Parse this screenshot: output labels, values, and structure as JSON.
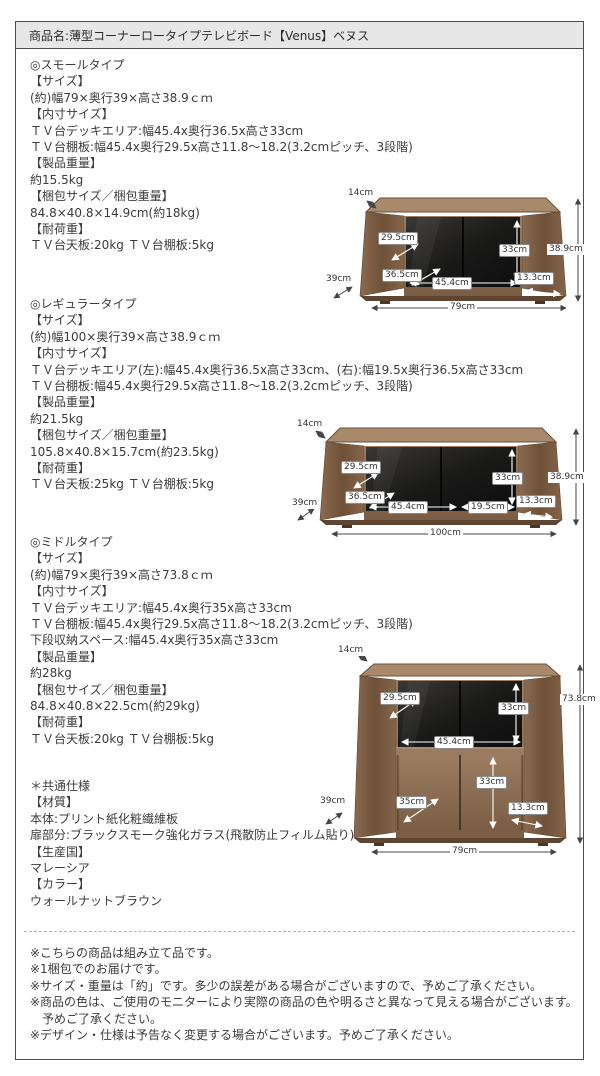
{
  "header": {
    "title": "商品名:薄型コーナーロータイプテレビボード【Venus】ベヌス"
  },
  "small": {
    "heading": "◎スモールタイプ",
    "lines": [
      "【サイズ】",
      "(約)幅79×奥行39×高さ38.9ｃｍ",
      "【内寸サイズ】",
      "ＴＶ台デッキエリア:幅45.4x奥行36.5x高さ33cm",
      "ＴＶ台棚板:幅45.4x奥行29.5x高さ11.8〜18.2(3.2cmピッチ、3段階)",
      "【製品重量】",
      "約15.5kg",
      "【梱包サイズ／梱包重量】",
      "84.8×40.8×14.9cm(約18kg)",
      "【耐荷重】",
      "ＴＶ台天板:20kg ＴＶ台棚板:5kg"
    ],
    "labels": {
      "top_depth": "14cm",
      "shelf_depth": "29.5cm",
      "deck_depth": "36.5cm",
      "depth": "39cm",
      "deck_width": "45.4cm",
      "deck_height": "33cm",
      "side_width": "13.3cm",
      "height": "38.9cm",
      "width": "79cm"
    }
  },
  "regular": {
    "heading": "◎レギュラータイプ",
    "lines": [
      "【サイズ】",
      "(約)幅100×奥行39×高さ38.9ｃｍ",
      "【内寸サイズ】",
      "ＴＶ台デッキエリア(左):幅45.4x奥行36.5x高さ33cm、(右):幅19.5x奥行36.5x高さ33cm",
      "ＴＶ台棚板:幅45.4x奥行29.5x高さ11.8〜18.2(3.2cmピッチ、3段階)",
      "【製品重量】",
      "約21.5kg",
      "【梱包サイズ／梱包重量】",
      "105.8×40.8×15.7cm(約23.5kg)",
      "【耐荷重】",
      "ＴＶ台天板:25kg ＴＶ台棚板:5kg"
    ],
    "labels": {
      "top_depth": "14cm",
      "shelf_depth": "29.5cm",
      "deck_depth": "36.5cm",
      "depth": "39cm",
      "deck_width": "45.4cm",
      "right_deck_width": "19.5cm",
      "deck_height": "33cm",
      "side_width": "13.3cm",
      "height": "38.9cm",
      "width": "100cm"
    }
  },
  "middle": {
    "heading": "◎ミドルタイプ",
    "lines": [
      "【サイズ】",
      "(約)幅79×奥行39×高さ73.8ｃｍ",
      "【内寸サイズ】",
      "ＴＶ台デッキエリア:幅45.4x奥行35x高さ33cm",
      "ＴＶ台棚板:幅45.4x奥行29.5x高さ11.8〜18.2(3.2cmピッチ、3段階)",
      "下段収納スペース:幅45.4x奥行35x高さ33cm",
      "【製品重量】",
      "約28kg",
      "【梱包サイズ／梱包重量】",
      "84.8×40.8×22.5cm(約29kg)",
      "【耐荷重】",
      "ＴＶ台天板:20kg ＴＶ台棚板:5kg"
    ],
    "labels": {
      "top_depth": "14cm",
      "shelf_depth": "29.5cm",
      "upper_height": "33cm",
      "deck_width": "45.4cm",
      "lower_depth": "35cm",
      "lower_height": "33cm",
      "side_width": "13.3cm",
      "depth": "39cm",
      "height": "73.8cm",
      "width": "79cm"
    }
  },
  "common": {
    "heading": "＊共通仕様",
    "lines": [
      "【材質】",
      "本体:プリント紙化粧繊維板",
      "扉部分:ブラックスモーク強化ガラス(飛散防止フィルム貼り)",
      "【生産国】",
      "マレーシア",
      "【カラー】",
      "ウォールナットブラウン"
    ]
  },
  "notes": {
    "lines": [
      "※こちらの商品は組み立て品です。",
      "※1梱包でのお届けです。",
      "※サイズ・重量は「約」です。多少の誤差がある場合がございますので、予めご了承ください。",
      "※商品の色は、ご使用のモニターにより実際の商品の色や明るさと異なって見える場合がございます。",
      "予めご了承ください。",
      "※デザイン・仕様は予告なく変更する場合がございます。予めご了承ください。"
    ]
  },
  "colors": {
    "header_bg": "#e7e7e7",
    "border": "#4d4d4d",
    "wood": "#8a6c52",
    "glass": "#141416"
  }
}
